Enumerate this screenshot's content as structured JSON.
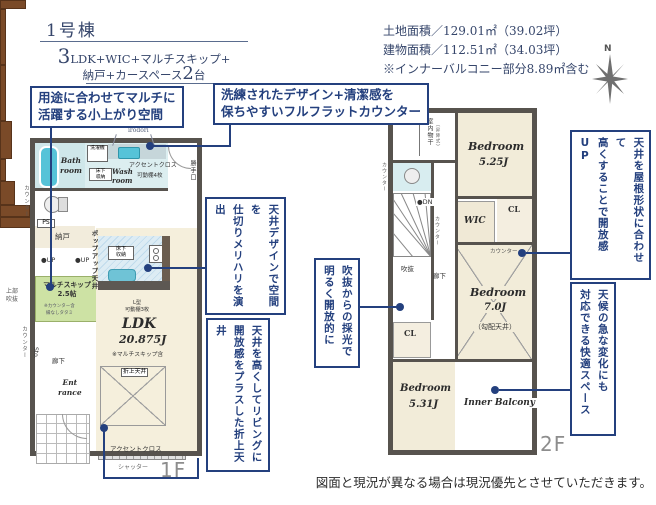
{
  "colors": {
    "accent": "#24407e",
    "wall": "#57534e",
    "floor_beige": "#f2ecd9",
    "tatami_green": "#cde2a4",
    "water_blue": "#d8edf0",
    "tub_blue": "#56c3d8",
    "wood_brown": "#7a4a28",
    "gray_label": "#8d8d8d"
  },
  "header": {
    "building": "1号棟",
    "layout": {
      "num1": "3",
      "part1": "LDK+WIC+マルチスキップ+",
      "part2": "納戸+カースペース",
      "num2": "2",
      "part3": "台"
    },
    "land_area": "土地面積／129.01㎡（39.02坪）",
    "building_area": "建物面積／112.51㎡（34.03坪）",
    "balcony_note": "※インナーバルコニー部分8.89㎡含む",
    "compass_n": "N"
  },
  "callouts": {
    "koagari": "用途に合わせてマルチに\n活躍する小上がり空間",
    "flat_counter": "洗練されたデザイン+清潔感を\n保ちやすいフルフラットカウンター",
    "ceiling_design": {
      "l1": "天井デザインで空間を",
      "l2": "仕切りメリハリを演出"
    },
    "oriage": {
      "l1": "天井を高くしてリビングに",
      "l2": "開放感をプラスした折上天井"
    },
    "fukinuke_light": {
      "l1": "吹抜からの採光で",
      "l2": "明るく開放的に"
    },
    "roof_ceiling": {
      "l1": "天井を屋根形状に合わせて",
      "l2": "高くすることで開放感UP"
    },
    "weather": {
      "l1": "天候の急な変化にも",
      "l2": "対応できる快適スペース"
    }
  },
  "f1": {
    "floor_label": "1F",
    "open_sanitary": "オープンサニタリー",
    "open_sanitary_sub": "irodori",
    "washer": "洗濯機",
    "bath": "Bath\nroom",
    "accent_cloth_top": "アクセントクロス",
    "wash": "Wash\nroom",
    "shelf4": "可動棚4枚",
    "underfloor_wash": "床下\n収納",
    "back_door": "勝手口",
    "counter_left1": "カウンター",
    "ps": "PS",
    "nando": "納戸",
    "up1": "●UP",
    "up2": "●UP",
    "multi_skip": "マルチスキップ\n2.5帖",
    "multi_note1": "※カウンター含",
    "multi_note2": "縁なしタタミ",
    "upper_void": "上部\n吹抜",
    "counter_left2": "カウンター",
    "sto": "Sto.",
    "hallway": "廊下",
    "popup_ceiling": "ポップアップ天井",
    "underfloor_kitchen": "床下\n収納",
    "l_shelf": "L型\n可動棚3枚",
    "ldk": "LDK",
    "ldk_size": "20.875J",
    "ldk_note": "※マルチスキップ含",
    "oriage_label": "折上天井",
    "entrance": "Ent\nrance",
    "accent_cloth_bottom": "アクセントクロス",
    "shutter": "シャッター"
  },
  "f2": {
    "floor_label": "2F",
    "indoor_drying": "室内物干",
    "indoor_drying_sub": "（昇降式）",
    "counter_toilet": "カウンター",
    "bedroom1": "Bedroom",
    "bedroom1_size": "5.25J",
    "dn": "●DN",
    "counter_stairs": "カウンター",
    "wic": "WIC",
    "cl1": "CL",
    "fukinuke": "吹抜",
    "hallway": "廊下",
    "counter_bedroom": "カウンター",
    "bedroom2": "Bedroom",
    "bedroom2_size": "7.0J",
    "bedroom2_note": "（勾配天井）",
    "cl2": "CL",
    "bedroom3": "Bedroom",
    "bedroom3_size": "5.31J",
    "inner_balcony": "Inner Balcony"
  },
  "footer": {
    "disclaimer": "図面と現況が異なる場合は現況優先とさせていただきます。"
  }
}
